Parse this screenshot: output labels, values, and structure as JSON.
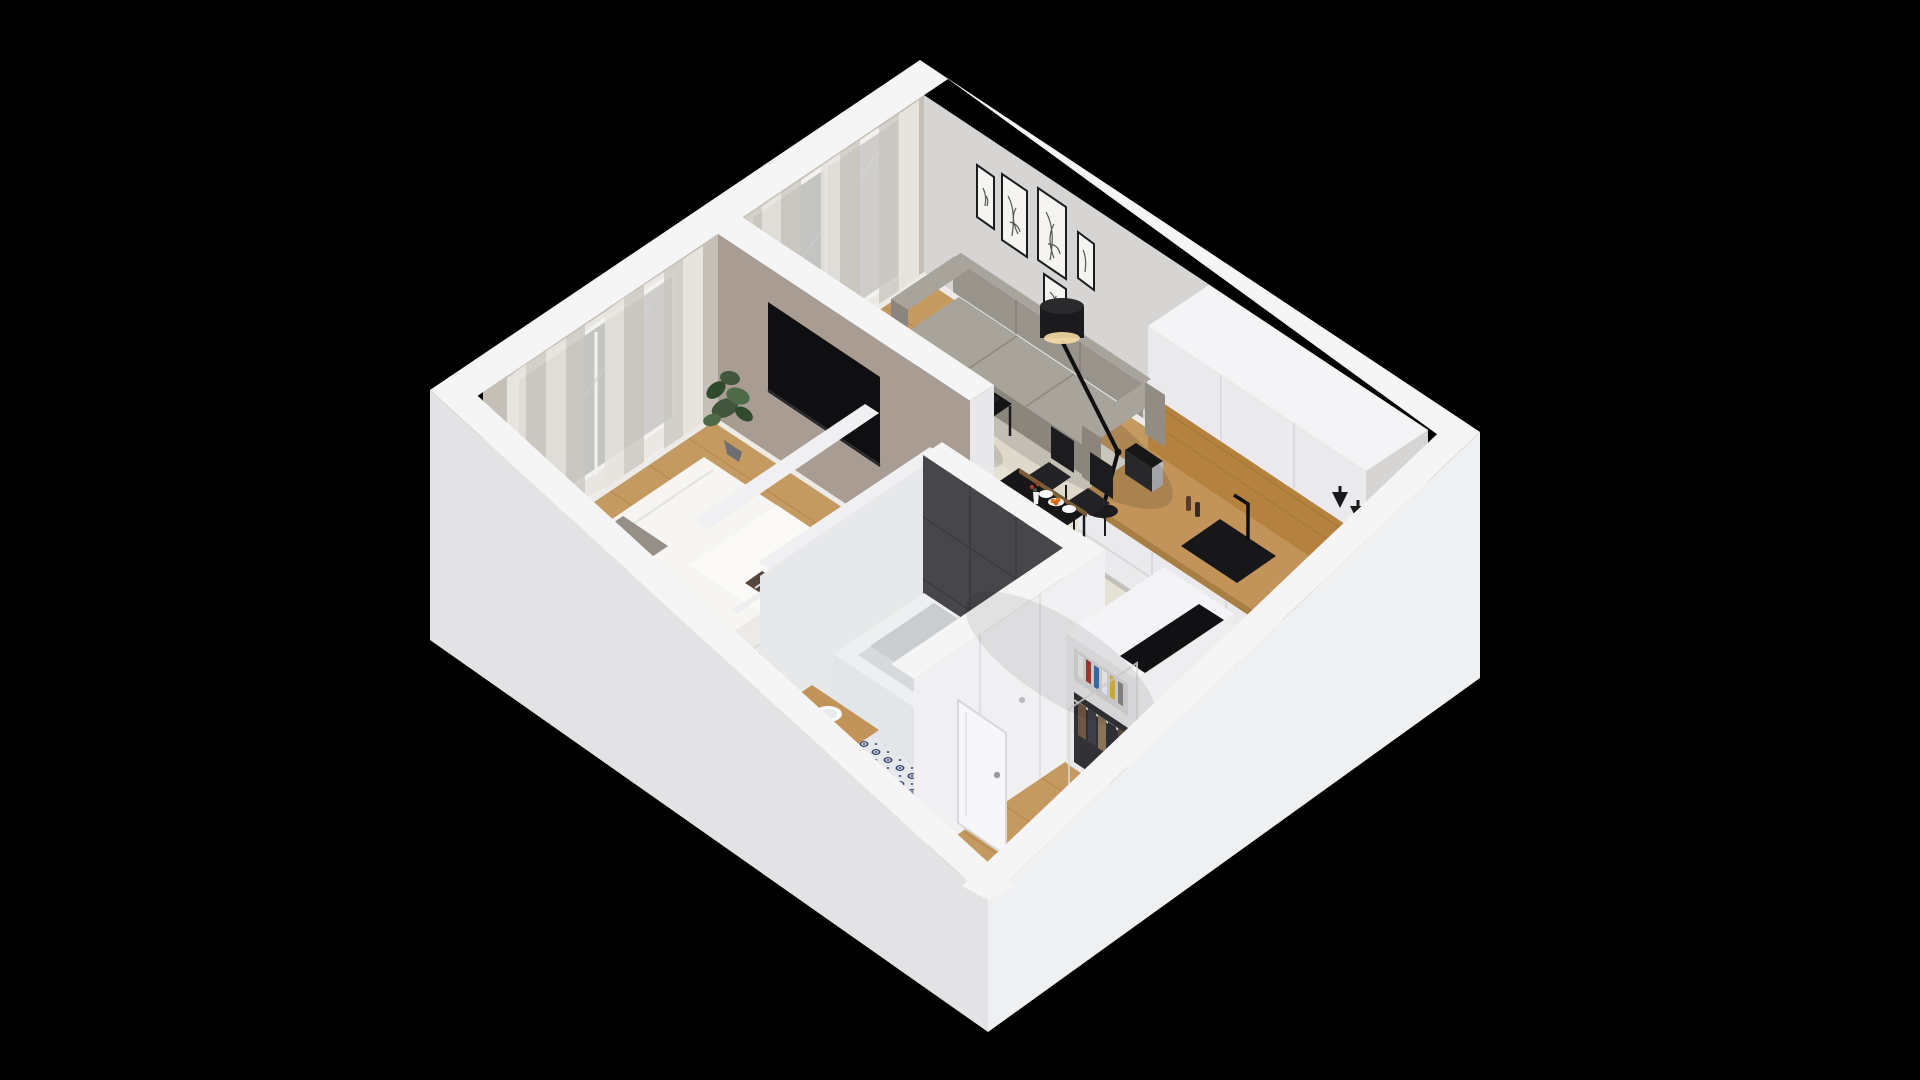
{
  "scene": {
    "label": "isometric-3d-apartment-floor-plan",
    "background": "#000000",
    "projection": "isometric-cutaway",
    "frame_count": 5,
    "dining_chair_count": 4,
    "sofa_seat_count": 3
  },
  "palette": {
    "bg": "#000000",
    "wall_top": "#f5f5f6",
    "wall_ext_sw": "#e3e3e6",
    "wall_ext_se": "#eef0f1",
    "wall_int_light": "#d7d5d3",
    "wall_int_greige": "#c5bfb8",
    "partition_taupe": "#a89c93",
    "baseboard": "#ecebe8",
    "wood_floor": "#c49a61",
    "plank_line": "#a87f46",
    "rug_living": "#e6e1d5",
    "rug_living_stripe": "#dcd6c7",
    "rug_bedroom": "#bab6b2",
    "sofa_body": "#99948b",
    "sofa_light": "#a8a39b",
    "sofa_dark": "#8a857d",
    "black": "#131315",
    "soft_black": "#232326",
    "counter_wood": "#c2945a",
    "backsplash_wood": "#b5813f",
    "cabinet_white": "#eaeaec",
    "cabinet_top": "#f4f4f6",
    "tile_dark": "#47474b",
    "tile_dark_line": "#3a3a3e",
    "bath_floor": "#e7e8eb",
    "bath_pattern": "#32406b",
    "tub_white": "#edeff0",
    "tub_inner": "#d6dadc",
    "bed_white": "#f6f5f1",
    "bed_fold": "#fbfaf7",
    "pillow_gray": "#a09a92",
    "plant_green": "#41563c",
    "plant_green2": "#4f6a47",
    "pot_gray": "#6f6f73",
    "glass": "#30353a",
    "curtain_a": "#e9e6e1",
    "curtain_b": "#d3cfc9",
    "curtain_sheer": "#f4f2ef",
    "steel": "#d5d5d8",
    "accent_orange": "#e2781e",
    "accent_red": "#a33b32",
    "accent_blue": "#3c6fb4",
    "accent_yellow": "#ddb832",
    "cloth1": "#6e5742",
    "cloth2": "#3f3f49",
    "cloth3": "#7d6a50",
    "cloth4": "#2e2e36",
    "cloth5": "#8a7458",
    "cloth6": "#55453a",
    "shadow": "#000000"
  },
  "rooms": [
    {
      "name": "living-room",
      "items": [
        "three-seat-sofa",
        "coffee-table",
        "cream-area-rug",
        "articulated-floor-lamp",
        "gallery-wall-5-frames",
        "balcony-door",
        "curtains"
      ]
    },
    {
      "name": "dining-area",
      "items": [
        "black-dining-table",
        "dining-chair-1",
        "dining-chair-2",
        "dining-chair-3",
        "dining-chair-4",
        "plates",
        "flower-vase",
        "fruit-bowl",
        "carafe"
      ]
    },
    {
      "name": "kitchen",
      "items": [
        "tall-white-cabinets",
        "oak-backsplash",
        "oak-countertop",
        "drawer-units",
        "black-sink",
        "black-faucet",
        "coffee-machine",
        "pepper-mills",
        "cooktop",
        "pot",
        "pan",
        "black-wall-lights"
      ]
    },
    {
      "name": "bedroom",
      "items": [
        "double-bed",
        "patterned-pillows",
        "gray-rug",
        "wall-tv",
        "window",
        "curtains",
        "potted-plant",
        "black-planter"
      ]
    },
    {
      "name": "walk-in-closet",
      "items": [
        "clothes-rail-row-1",
        "clothes-rail-row-2"
      ]
    },
    {
      "name": "bathroom",
      "items": [
        "bathtub",
        "charcoal-tile-wall",
        "ornament-tile-floor",
        "wood-vanity",
        "white-basin",
        "open-door",
        "black-mat"
      ]
    },
    {
      "name": "entry-hall",
      "items": [
        "open-wardrobe",
        "books",
        "hanging-clothes",
        "front-door",
        "doormat"
      ]
    },
    {
      "name": "balcony",
      "items": [
        "balcony-slab"
      ]
    }
  ]
}
